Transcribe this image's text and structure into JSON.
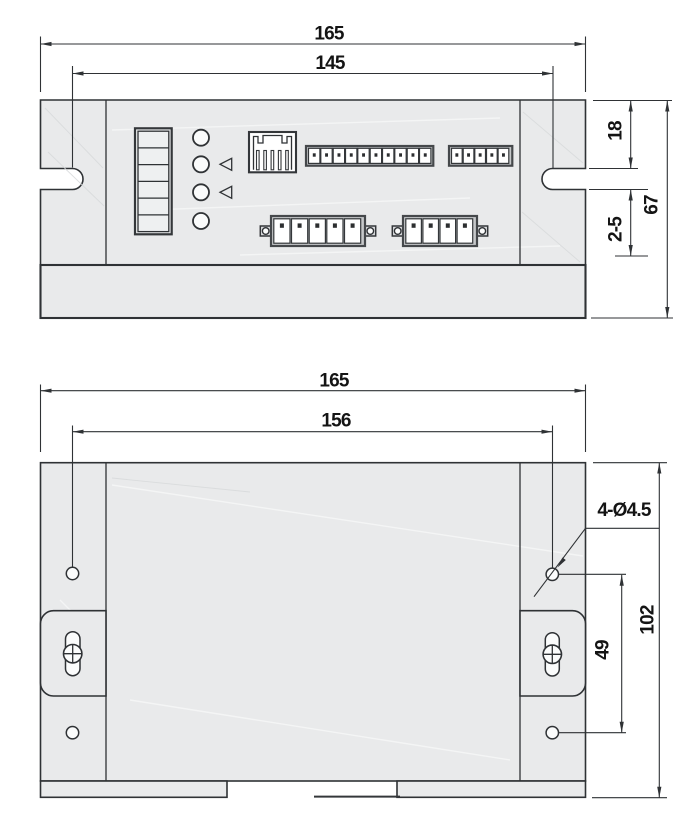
{
  "drawing": {
    "front_view": {
      "overall_width": "165",
      "slot_center_spacing": "145",
      "top_edge_to_slot": "18",
      "clamp_thickness_range": "2-5",
      "overall_height": "67"
    },
    "mounting_view": {
      "overall_width": "165",
      "hole_column_spacing": "156",
      "mounting_hole_callout": "4-Ø4.5",
      "hole_row_spacing": "49",
      "overall_height": "102"
    },
    "colors": {
      "background": "#ffffff",
      "body_fill": "#e9eaeb",
      "line": "#2f3235",
      "text": "#141414"
    }
  }
}
